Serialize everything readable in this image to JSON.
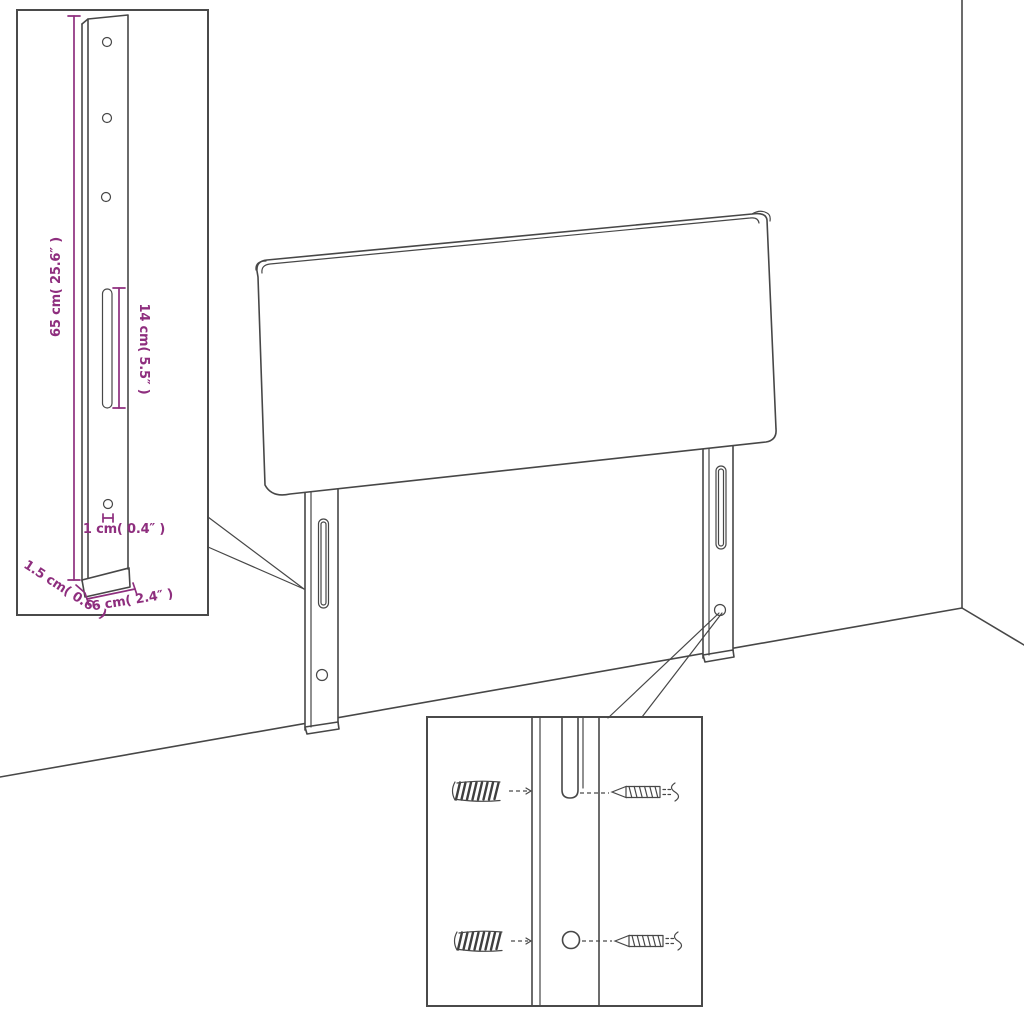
{
  "diagram": {
    "subject": "Headboard with two adjustable mounting legs shown in a room corner, with a dimensioned leg detail inset and a wall-mounting hardware inset",
    "colors": {
      "line": "#474747",
      "dimension": "#8e2e7e",
      "background": "#ffffff"
    },
    "leg_detail_inset": {
      "height_label": "65 cm( 25.6″ )",
      "slot_length_label": "14 cm( 5.5″ )",
      "hole_diameter_label": "1 cm( 0.4″ )",
      "thickness_label": "1.5 cm( 0.6″ )",
      "width_label": "6 cm( 2.4″ )"
    },
    "mounting_inset": {
      "icons": [
        "wall-plug-icon",
        "screw-icon"
      ]
    }
  }
}
